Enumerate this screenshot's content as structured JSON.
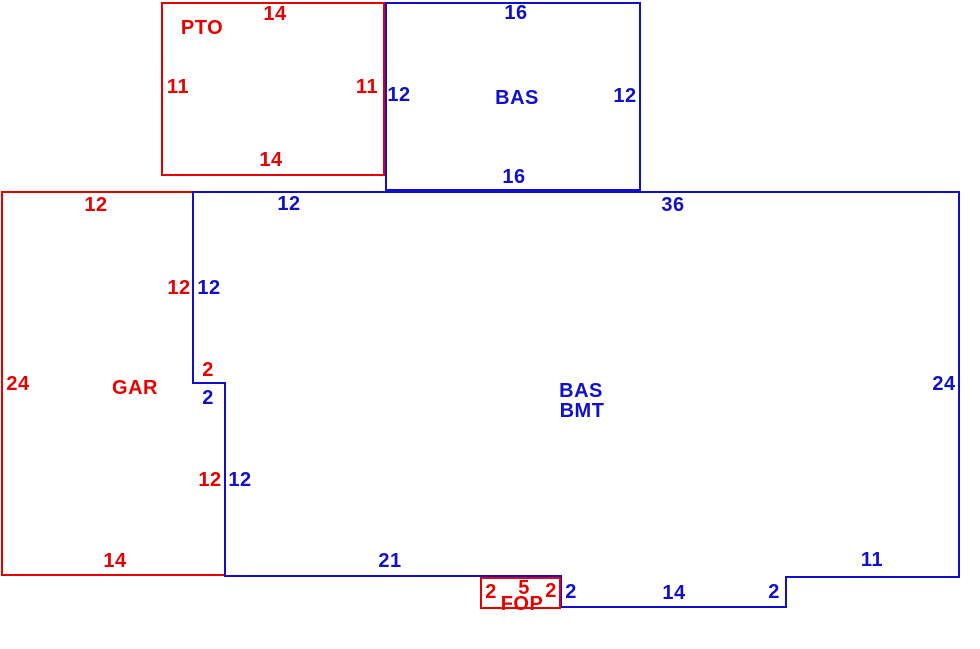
{
  "colors": {
    "red": "#e60000",
    "blue": "#0f0fcc"
  },
  "areas": {
    "pto": "PTO",
    "bas_upper": "BAS",
    "gar": "GAR",
    "bas_bmt": "BAS BMT",
    "fop": "FOP"
  },
  "labels": [
    {
      "name": "pto-dim-top",
      "text": "14",
      "color": "red",
      "x": 275,
      "y": 14
    },
    {
      "name": "pto-area-label",
      "text": "PTO",
      "color": "red",
      "x": 202,
      "y": 28
    },
    {
      "name": "pto-dim-left",
      "text": "11",
      "color": "red",
      "x": 178,
      "y": 87
    },
    {
      "name": "pto-dim-right",
      "text": "11",
      "color": "red",
      "x": 367,
      "y": 87
    },
    {
      "name": "pto-dim-bottom",
      "text": "14",
      "color": "red",
      "x": 271,
      "y": 160
    },
    {
      "name": "bas-dim-top",
      "text": "16",
      "color": "blue",
      "x": 516,
      "y": 13
    },
    {
      "name": "bas-dim-left",
      "text": "12",
      "color": "blue",
      "x": 399,
      "y": 95
    },
    {
      "name": "bas-area-label",
      "text": "BAS",
      "color": "blue",
      "x": 517,
      "y": 98
    },
    {
      "name": "bas-dim-right",
      "text": "12",
      "color": "blue",
      "x": 625,
      "y": 96
    },
    {
      "name": "bas-dim-bottom",
      "text": "16",
      "color": "blue",
      "x": 514,
      "y": 177
    },
    {
      "name": "gar-dim-top",
      "text": "12",
      "color": "red",
      "x": 96,
      "y": 205
    },
    {
      "name": "bmt-dim-top-left",
      "text": "12",
      "color": "blue",
      "x": 289,
      "y": 204
    },
    {
      "name": "bmt-dim-top-right",
      "text": "36",
      "color": "blue",
      "x": 673,
      "y": 205
    },
    {
      "name": "gar-dim-right-upper",
      "text": "12",
      "color": "red",
      "x": 179,
      "y": 288
    },
    {
      "name": "bmt-dim-notch-upper",
      "text": "12",
      "color": "blue",
      "x": 209,
      "y": 288
    },
    {
      "name": "gar-dim-jog",
      "text": "2",
      "color": "red",
      "x": 208,
      "y": 370
    },
    {
      "name": "bmt-dim-jog",
      "text": "2",
      "color": "blue",
      "x": 208,
      "y": 398
    },
    {
      "name": "gar-dim-left",
      "text": "24",
      "color": "red",
      "x": 18,
      "y": 384
    },
    {
      "name": "gar-area-label",
      "text": "GAR",
      "color": "red",
      "x": 135,
      "y": 388
    },
    {
      "name": "bmt-area-label-line1",
      "text": "BAS",
      "color": "blue",
      "x": 581,
      "y": 391
    },
    {
      "name": "bmt-area-label-line2",
      "text": "BMT",
      "color": "blue",
      "x": 582,
      "y": 411
    },
    {
      "name": "bmt-dim-right",
      "text": "24",
      "color": "blue",
      "x": 944,
      "y": 384
    },
    {
      "name": "gar-dim-right-lower",
      "text": "12",
      "color": "red",
      "x": 210,
      "y": 480
    },
    {
      "name": "bmt-dim-notch-lower",
      "text": "12",
      "color": "blue",
      "x": 240,
      "y": 480
    },
    {
      "name": "gar-dim-bottom",
      "text": "14",
      "color": "red",
      "x": 115,
      "y": 561
    },
    {
      "name": "bmt-dim-bottom-left",
      "text": "21",
      "color": "blue",
      "x": 390,
      "y": 561
    },
    {
      "name": "fop-dim-left",
      "text": "2",
      "color": "red",
      "x": 491,
      "y": 592
    },
    {
      "name": "fop-dim-top",
      "text": "5",
      "color": "red",
      "x": 524,
      "y": 588
    },
    {
      "name": "fop-area-label",
      "text": "FOP",
      "color": "red",
      "x": 522,
      "y": 604
    },
    {
      "name": "fop-dim-right",
      "text": "2",
      "color": "red",
      "x": 551,
      "y": 591
    },
    {
      "name": "bmt-dim-fop-step",
      "text": "2",
      "color": "blue",
      "x": 571,
      "y": 592
    },
    {
      "name": "bmt-dim-bottom-mid",
      "text": "14",
      "color": "blue",
      "x": 674,
      "y": 593
    },
    {
      "name": "bmt-dim-right-step",
      "text": "2",
      "color": "blue",
      "x": 774,
      "y": 592
    },
    {
      "name": "bmt-dim-bottom-right",
      "text": "11",
      "color": "blue",
      "x": 872,
      "y": 560
    }
  ]
}
